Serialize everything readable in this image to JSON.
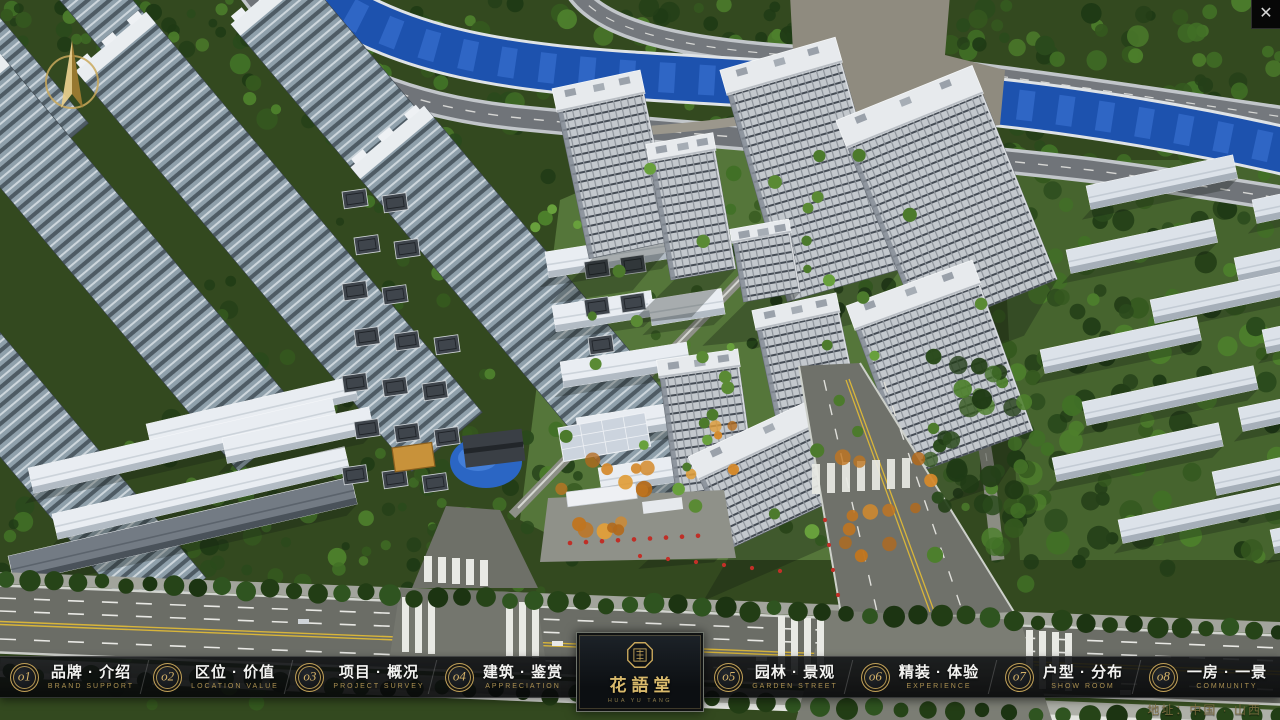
{
  "window": {
    "close_icon": "✕"
  },
  "menu": {
    "items": [
      {
        "num": "o1",
        "title": "品牌 · 介绍",
        "subtitle": "BRAND SUPPORT"
      },
      {
        "num": "o2",
        "title": "区位 · 价值",
        "subtitle": "LOCATION VALUE"
      },
      {
        "num": "o3",
        "title": "项目 · 概况",
        "subtitle": "PROJECT SURVEY"
      },
      {
        "num": "o4",
        "title": "建筑 · 鉴赏",
        "subtitle": "APPRECIATION"
      },
      {
        "num": "o5",
        "title": "园林 · 景观",
        "subtitle": "GARDEN STREET"
      },
      {
        "num": "o6",
        "title": "精装 · 体验",
        "subtitle": "EXPERIENCE"
      },
      {
        "num": "o7",
        "title": "户型 · 分布",
        "subtitle": "SHOW ROOM"
      },
      {
        "num": "o8",
        "title": "一房 · 一景",
        "subtitle": "COMMUNITY"
      }
    ]
  },
  "logo": {
    "name": "花語堂",
    "tagline": "HUA YU TANG"
  },
  "footer": {
    "address": "地址：中国 · 山西"
  },
  "colors": {
    "gold": "#c9a85c",
    "bar_bg": "#0b0d0f",
    "river": "#1d52ae"
  }
}
